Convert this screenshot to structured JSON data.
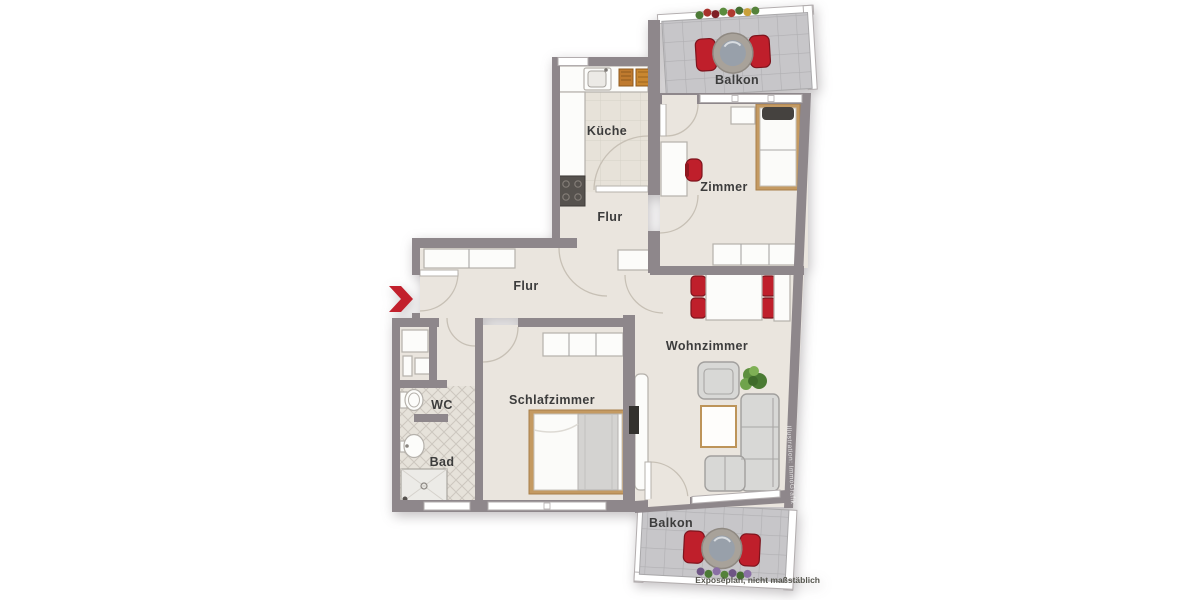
{
  "plan": {
    "rooms": {
      "kueche": "Küche",
      "zimmer": "Zimmer",
      "flur_oben": "Flur",
      "flur_unten": "Flur",
      "wohnzimmer": "Wohnzimmer",
      "schlafzimmer": "Schlafzimmer",
      "wc": "WC",
      "bad": "Bad",
      "balkon_oben": "Balkon",
      "balkon_unten": "Balkon"
    },
    "caption": "Exposéplan, nicht maßstäblich",
    "watermark": "Illustration: ImmoGrafik",
    "colors": {
      "wall": "#8e878b",
      "floor": "#eae5de",
      "kitchen_tile": "#e7e2d9",
      "bath_tile": "#e6e2da",
      "balcony_tile": "#c7c6c9",
      "accent_red": "#c2202c",
      "wood": "#c49a62",
      "sofa_gray": "#d8d8d6",
      "label_text": "#3c3c3c"
    }
  }
}
